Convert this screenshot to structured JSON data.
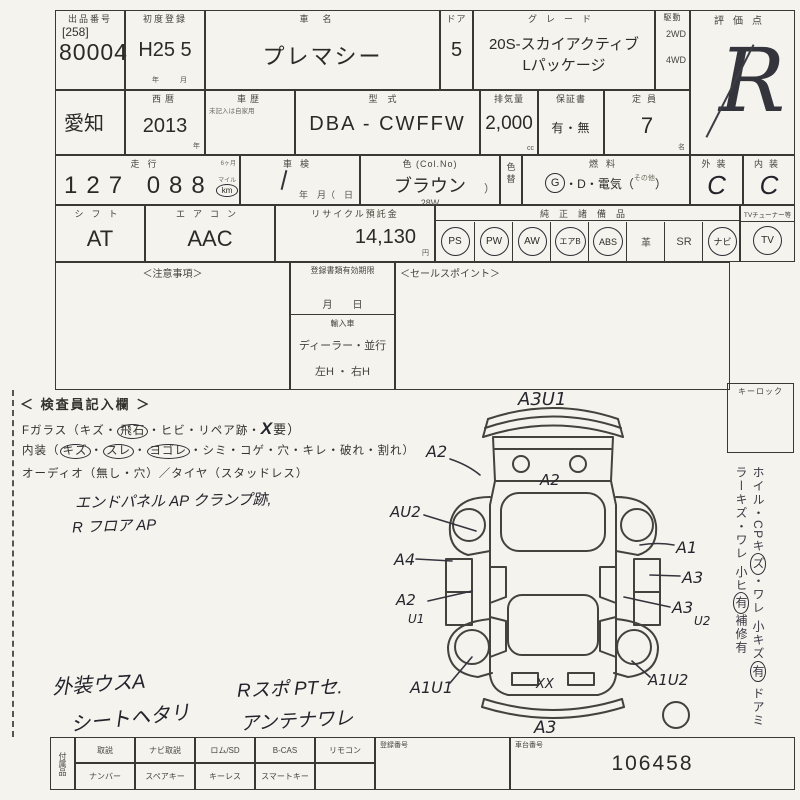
{
  "lot": {
    "header": "出品番号",
    "bracket": "[258]",
    "number": "80004"
  },
  "first_reg": {
    "header": "初度登録",
    "value": "H25 5",
    "unit_year": "年",
    "unit_month": "月"
  },
  "car_name": {
    "header": "車名",
    "value": "プレマシー"
  },
  "door": {
    "header": "ドア",
    "value": "5"
  },
  "grade": {
    "header": "グレード",
    "line1": "20S-スカイアクティブ",
    "line2": "Lパッケージ"
  },
  "drive": {
    "header": "駆動",
    "opt1": "2WD",
    "opt2": "4WD"
  },
  "score": {
    "header": "評価点",
    "value": "R"
  },
  "region": {
    "value": "愛知"
  },
  "year": {
    "header": "西暦",
    "value": "2013",
    "unit": "年"
  },
  "history": {
    "header": "車歴",
    "note": "未記入は自家用"
  },
  "model": {
    "header": "型式",
    "value": "DBA - CWFFW"
  },
  "displacement": {
    "header": "排気量",
    "value": "2,000",
    "unit": "cc"
  },
  "warranty": {
    "header": "保証書",
    "value": "有・無"
  },
  "capacity": {
    "header": "定員",
    "value": "7",
    "unit": "名"
  },
  "mileage": {
    "header": "走行",
    "small_note": "6ヶ月",
    "value": "127 088",
    "mile": "マイル",
    "km": "km"
  },
  "shaken": {
    "header": "車検",
    "labels": "年　月（　日"
  },
  "color": {
    "header": "色 (Col.No)",
    "value": "ブラウン",
    "code": "28W",
    "paren": "）"
  },
  "color_change": {
    "label": "色替"
  },
  "fuel": {
    "header": "燃料",
    "g": "G",
    "mid": "・D・電気（",
    "other": "その他",
    "close": "）"
  },
  "exterior": {
    "header": "外装",
    "value": "C"
  },
  "interior": {
    "header": "内装",
    "value": "C"
  },
  "shift": {
    "header": "シフト",
    "value": "AT"
  },
  "aircon": {
    "header": "エアコン",
    "value": "AAC"
  },
  "recycle": {
    "header": "リサイクル預託金",
    "value": "14,130",
    "unit": "円"
  },
  "equipment": {
    "header": "純正諸備品",
    "items": [
      {
        "label": "PS",
        "circled": true
      },
      {
        "label": "PW",
        "circled": true
      },
      {
        "label": "AW",
        "circled": true
      },
      {
        "label": "エアB",
        "circled": true
      },
      {
        "label": "ABS",
        "circled": true
      },
      {
        "label": "革",
        "circled": false
      },
      {
        "label": "SR",
        "circled": false
      },
      {
        "label": "ナビ",
        "circled": true
      }
    ],
    "tuner_header": "TVチューナー等",
    "tuner_label": "TV",
    "tuner_circled": true
  },
  "notes_box": {
    "title": "＜注意事項＞"
  },
  "docs_box": {
    "header": "登録書類有効期限",
    "month_day": "月　　日",
    "import_label": "輸入車",
    "dealer": "ディーラー・並行",
    "handle": "左H ・ 右H"
  },
  "sales_box": {
    "title": "＜セールスポイント＞"
  },
  "keylock": {
    "label": "キーロック"
  },
  "side_notes": {
    "line1_pre": "ホイル・CPキ",
    "line1_c1": "ズ",
    "line1_mid": "・ワレ 小キズ",
    "line1_c2": "有",
    "line2_pre": "ドアミラーキズ・ワレ 小ヒ",
    "line2_c1": "有",
    "line2_post": "補修有"
  },
  "inspector": {
    "title": "＜ 検査員記入欄 ＞",
    "dot": "・",
    "l1_pre": "Fガラス（キズ・",
    "l1_circ": "飛石",
    "l1_mid": "・ヒビ・リペア跡・",
    "l1_x": "X",
    "l1_post": "要）",
    "l2_pre": "内装（",
    "l2_c1": "キズ",
    "l2_c2": "スレ",
    "l2_c3": "ヨゴレ",
    "l2_post": "・シミ・コゲ・穴・キレ・破れ・割れ）",
    "l3": "オーディオ（無し・穴）／タイヤ（スタッドレス）",
    "hw1": "エンドパネル AP クランプ跡,",
    "hw2": "R フロア AP",
    "hw3": "外装ウスA",
    "hw4": "シートヘタリ",
    "hw5": "Rスポ PTセ.",
    "hw6": "アンテナワレ"
  },
  "diagram": {
    "a3u1": "A3U1",
    "a2_fender": "A2",
    "a2_hood": "A2",
    "au2": "AU2",
    "a4": "A4",
    "a2u1": "A2",
    "u1": "U1",
    "a1u1": "A1U1",
    "a1": "A1",
    "a3_right": "A3",
    "a3u2": "A3",
    "u2": "U2",
    "a1u2": "A1U2",
    "xx": "XX",
    "a3_bottom": "A3"
  },
  "bottom": {
    "side_label": "付属品",
    "row1": [
      "取説",
      "ナビ取説",
      "ロム/SD",
      "B-CAS",
      "リモコン"
    ],
    "row2": [
      "ナンバー",
      "スペアキー",
      "キーレス",
      "スマートキー"
    ],
    "reg_header": "登録番号",
    "chassis_header": "車台番号",
    "chassis_value": "106458"
  },
  "colors": {
    "paper": "#f4f3ed",
    "ink": "#3a3832",
    "hand": "#23232c"
  }
}
